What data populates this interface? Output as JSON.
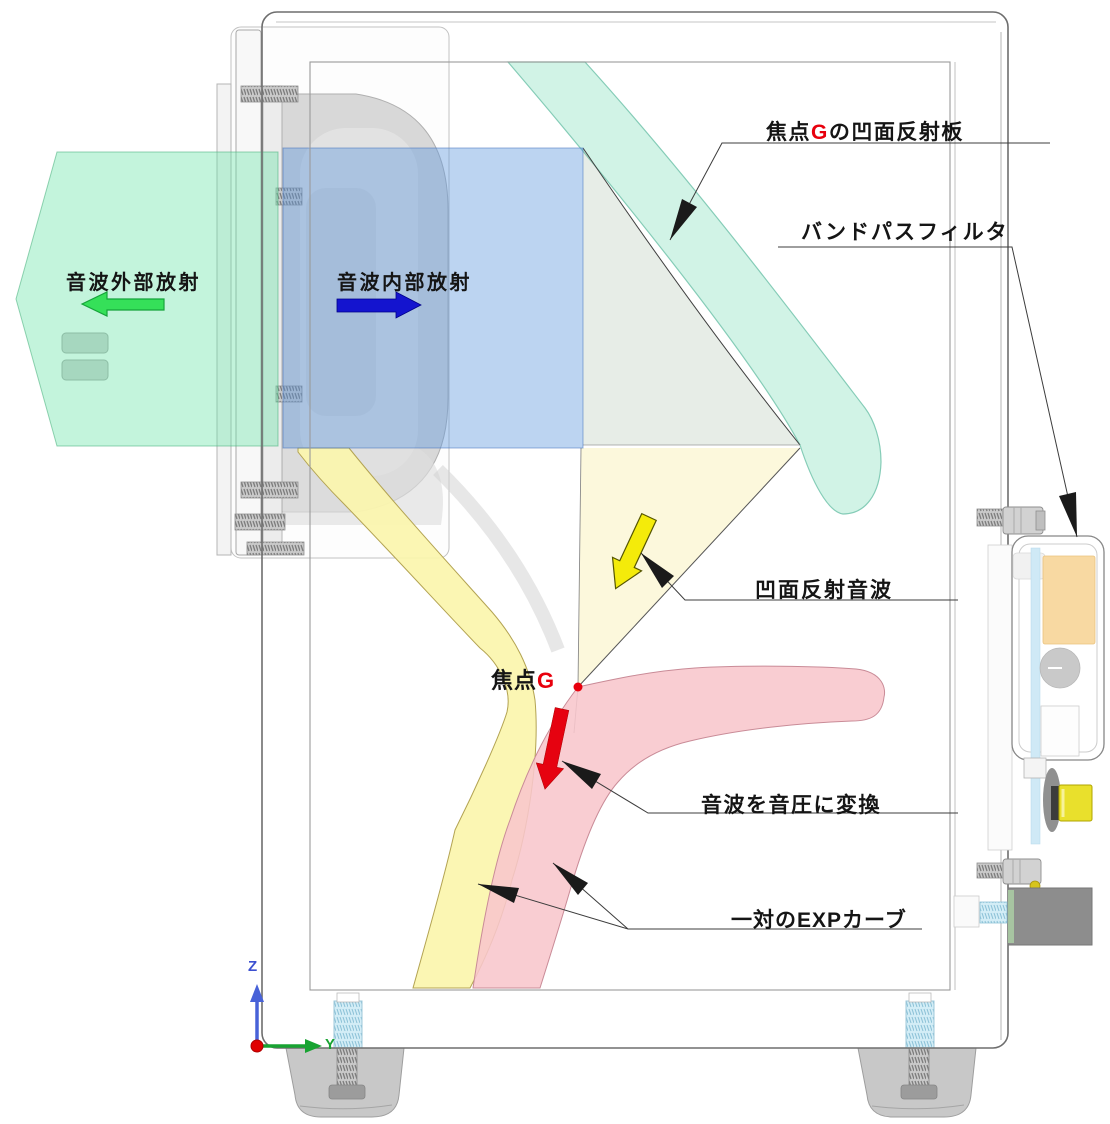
{
  "labels": {
    "reflector": {
      "pre": "焦点",
      "g": "G",
      "post": "の凹面反射板"
    },
    "bandpass": "バンドパスフィルタ",
    "reflected": "凹面反射音波",
    "focal": {
      "pre": "焦点",
      "g": "G"
    },
    "convert": "音波を音圧に変換",
    "exp": "一対のEXPカーブ",
    "external": "音波外部放射",
    "internal": "音波内部放射",
    "axis_z": "Z",
    "axis_y": "Y"
  },
  "colors": {
    "teal_band": "#c9f1e2",
    "teal_border": "#85ccb7",
    "green_beam": "rgba(105,228,168,0.40)",
    "blue_beam": "rgba(96,152,222,0.42)",
    "cream_beam": "#fcf8da",
    "yellow_band": "#fbf5ad",
    "yellow_border": "#b3a352",
    "pink_band": "#f8c6cc",
    "pink_border": "#c98b97",
    "green_arrow": "#35e059",
    "blue_arrow": "#1414cf",
    "yellow_arrow": "#f4eb0a",
    "red_arrow": "#e60210",
    "focal_red": "#e8000d",
    "axis_z_color": "#4862d8",
    "axis_y_color": "#18a332"
  }
}
